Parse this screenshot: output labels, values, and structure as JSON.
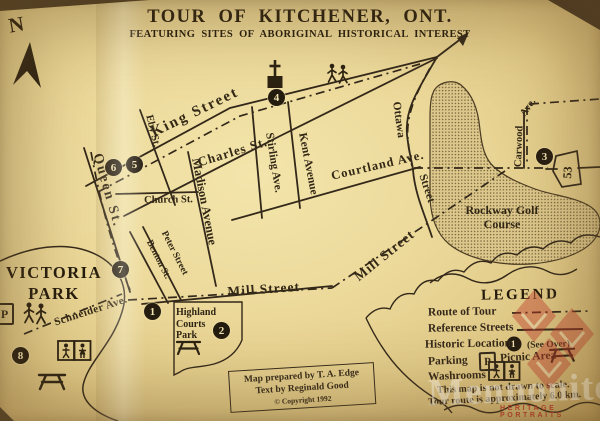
{
  "map": {
    "title": "TOUR OF KITCHENER, ONT.",
    "subtitle": "FEATURING SITES OF ABORIGINAL HISTORICAL INTEREST",
    "north_label": "N"
  },
  "streets": {
    "king": "King Street",
    "charles": "Charles St.",
    "eby": "Eby St.",
    "queen": "Queen St.",
    "church": "Church St.",
    "madison": "Madison Avenue",
    "stirling": "Stirling Ave.",
    "kent": "Kent Avenue",
    "benton": "Benton St.",
    "peter": "Peter Street",
    "mill_horizontal": "Mill Street",
    "mill_diagonal": "Mill Street",
    "courtland": "Courtland Ave.",
    "ottawa_word1": "Ottawa",
    "ottawa_word2": "Street",
    "carwood_word1": "Carwood",
    "carwood_word2": "Ave.",
    "schneider": "Schneider Ave."
  },
  "areas": {
    "victoria_park": "VICTORIA PARK",
    "highland_courts_park": "Highland Courts Park",
    "rockway_golf_course": "Rockway Golf Course"
  },
  "highway": {
    "route_53": "53"
  },
  "markers": [
    {
      "number": "1"
    },
    {
      "number": "2"
    },
    {
      "number": "3"
    },
    {
      "number": "4"
    },
    {
      "number": "5"
    },
    {
      "number": "6"
    },
    {
      "number": "7"
    },
    {
      "number": "8"
    }
  ],
  "legend": {
    "title": "LEGEND",
    "route_of_tour_label": "Route of Tour",
    "reference_streets_label": "Reference Streets",
    "historic_locations_label": "Historic Locations",
    "historic_sample_number": "1",
    "see_over_note": "(See Over)",
    "parking_label": "Parking",
    "parking_symbol": "P",
    "picnic_area_label": "Picnic Area",
    "washrooms_label": "Washrooms",
    "scale_note_line1": "This map is not drawn to scale.",
    "scale_note_line2": "Tour route is approximately 6.0 km."
  },
  "credits": {
    "prepared_by": "Map prepared by T. A. Edge",
    "text_by": "Text by Reginald Good",
    "copyright": "© Copyright 1992"
  },
  "watermark": {
    "brand": "Mennonite",
    "tagline": "HERITAGE PORTRAITS"
  },
  "colors": {
    "paper": "#e9d694",
    "ink": "#33281a",
    "marker_fill": "#251c10",
    "golf_stipple": "#756039",
    "watermark_red": "#b0392c"
  }
}
